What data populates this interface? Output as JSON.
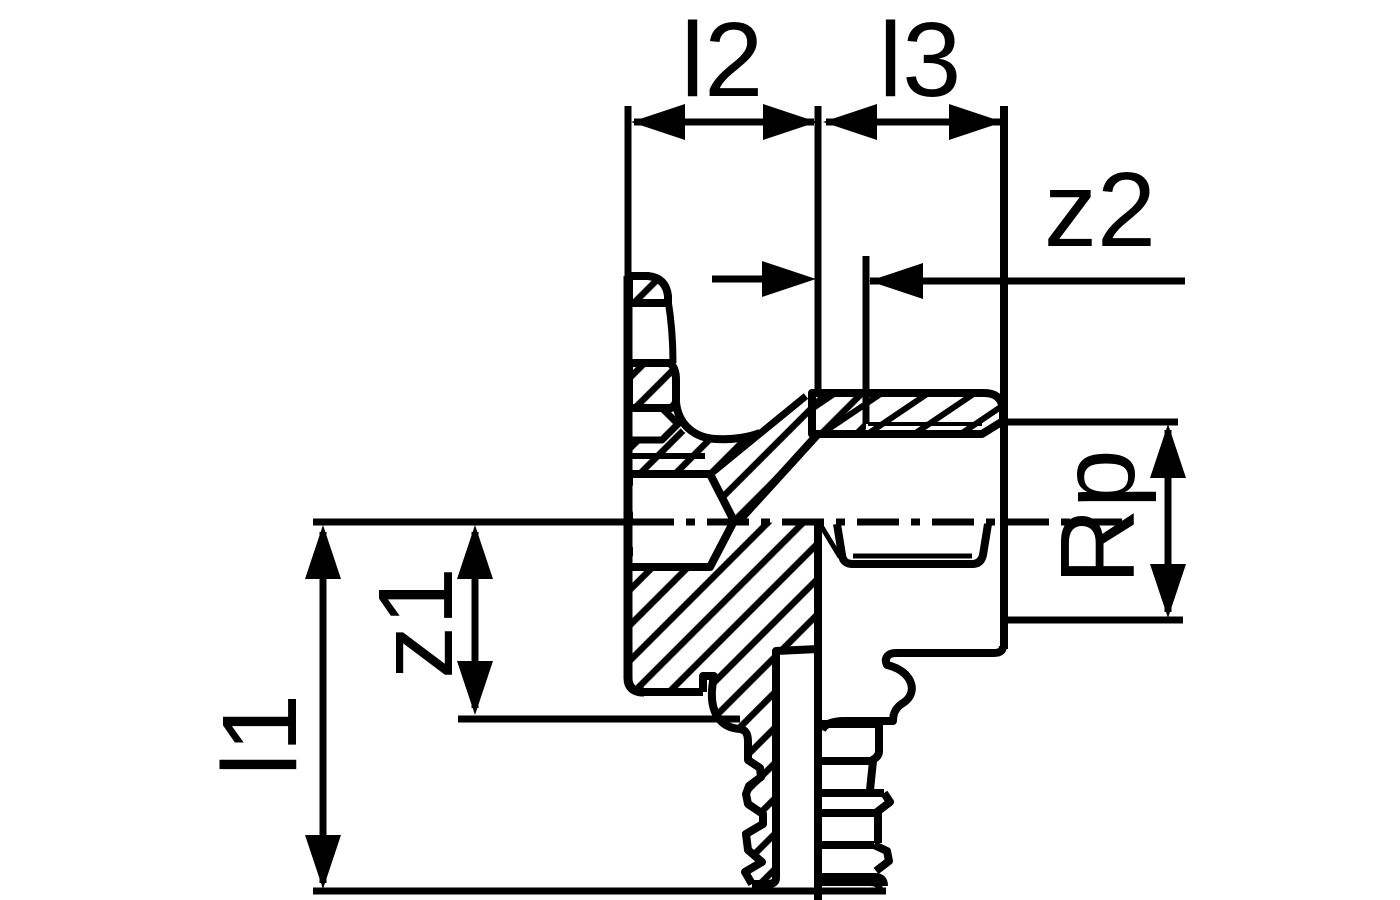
{
  "page": {
    "background": "#ffffff"
  },
  "drawing": {
    "kind": "pipe-fitting-cross-section-technical-drawing",
    "line_color": "#000000",
    "hatch_style": "diagonal-section-hatching",
    "dimensions": {
      "l2": {
        "label": "l2",
        "orientation": "horizontal"
      },
      "l3": {
        "label": "l3",
        "orientation": "horizontal"
      },
      "z2": {
        "label": "z2",
        "orientation": "horizontal"
      },
      "Rp": {
        "label": "Rp",
        "orientation": "vertical"
      },
      "z1": {
        "label": "z1",
        "orientation": "vertical"
      },
      "l1": {
        "label": "l1",
        "orientation": "vertical"
      }
    }
  }
}
